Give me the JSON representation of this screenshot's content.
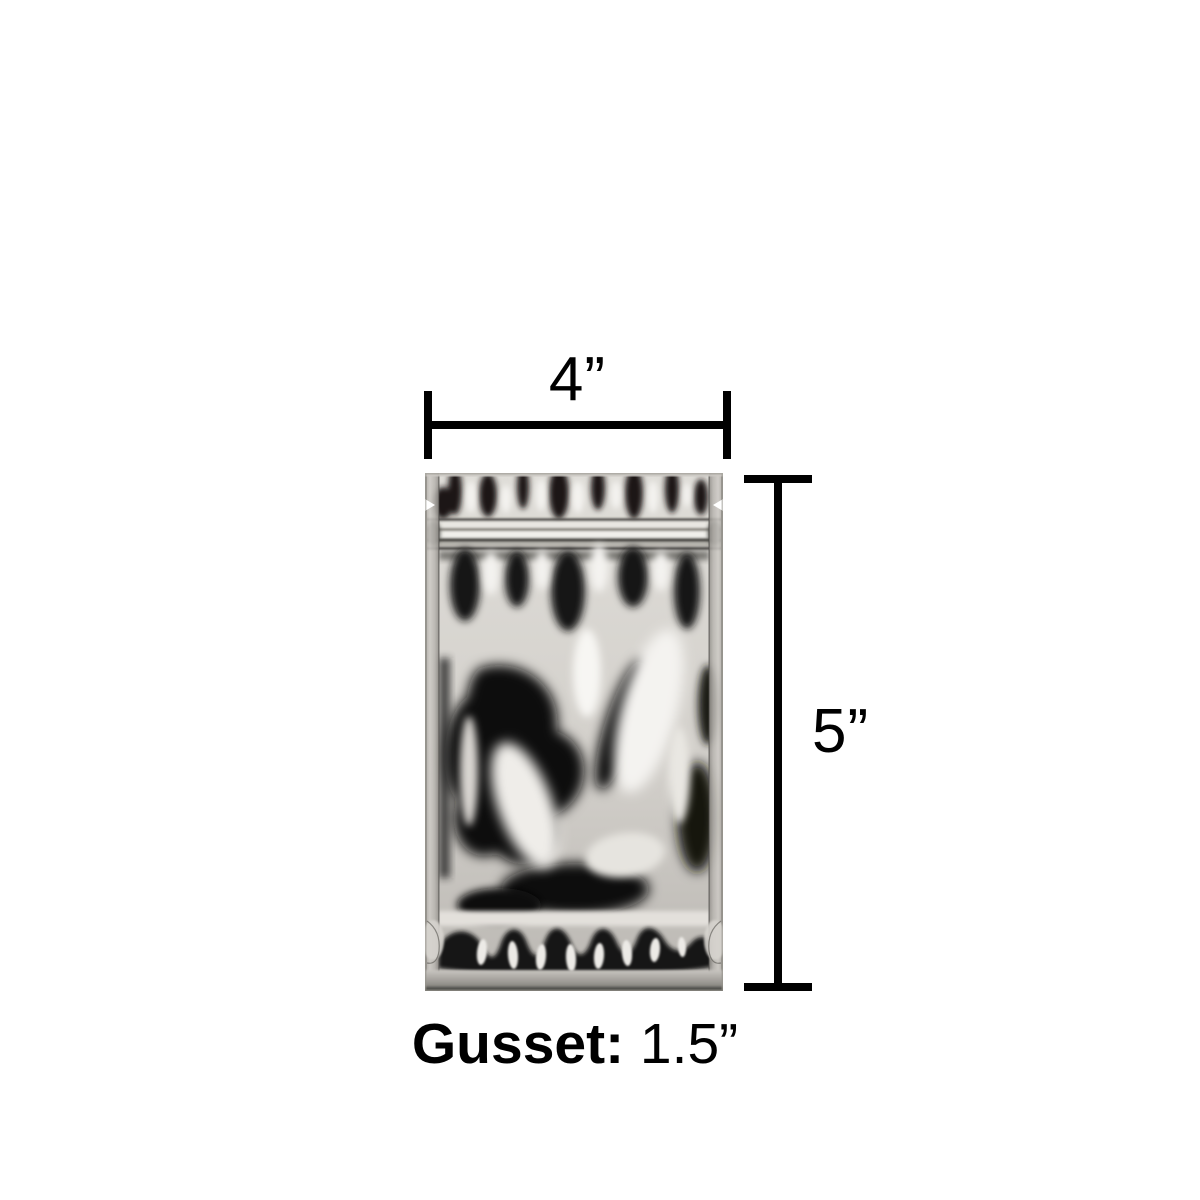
{
  "figure": {
    "type": "product-dimension-diagram",
    "background_color": "#ffffff",
    "annotation_color": "#000000",
    "product_description": "Silver metallic stand-up zipper pouch (mylar bag), front view with tear notches and bottom gusset",
    "pouch_colors": {
      "silver_base": "#d6d3ce",
      "silver_highlight": "#f3f2ef",
      "reflection_dark": "#0d0d0d",
      "seal_gray": "#b3b0ab"
    }
  },
  "dimensions": {
    "width": {
      "label": "4”"
    },
    "height": {
      "label": "5”"
    },
    "gusset": {
      "label": "Gusset:",
      "value": "1.5”"
    }
  }
}
